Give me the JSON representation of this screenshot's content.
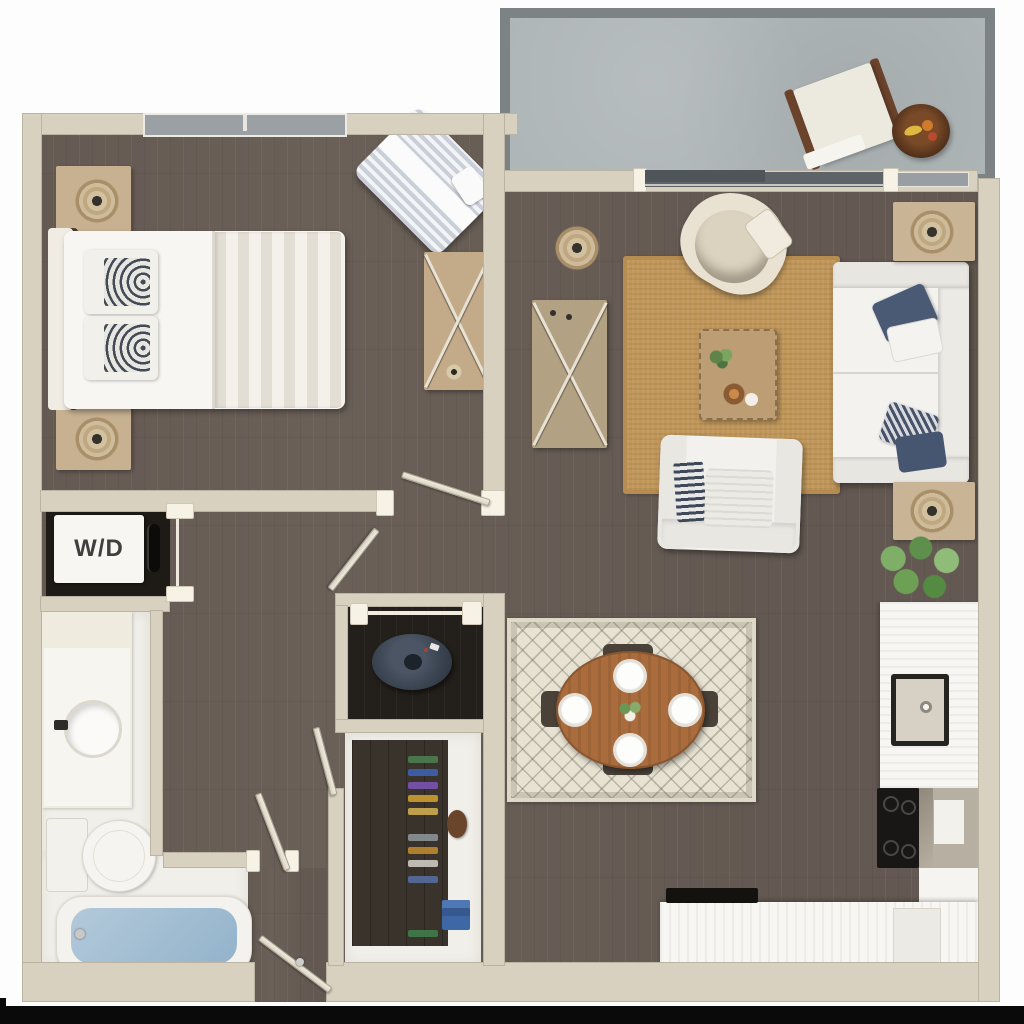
{
  "floorplan": {
    "title": "One-bedroom apartment 3D top-view floor plan",
    "washer_dryer_label": "W/D",
    "rooms": [
      "balcony",
      "bedroom",
      "living-room",
      "dining-area",
      "kitchen",
      "bathroom",
      "walk-in-closet",
      "storage-nook",
      "laundry-closet",
      "hallway",
      "entry"
    ],
    "furniture": {
      "balcony": [
        "sun-lounger",
        "fruit-bowl-table"
      ],
      "bedroom": [
        "queen-bed",
        "nightstand-with-lamp",
        "nightstand-with-lamp",
        "striped-chaise",
        "dresser"
      ],
      "living_room": [
        "sofa-with-navy-pillows",
        "accent-chair",
        "armchair",
        "coffee-table",
        "tv-console",
        "jute-rug",
        "side-table-with-lamp",
        "side-table-with-lamp",
        "pendant-lamp",
        "potted-plant"
      ],
      "dining": [
        "oval-wood-table",
        "dining-chair",
        "dining-chair",
        "dining-chair",
        "dining-chair",
        "patterned-rug",
        "place-setting-plates"
      ],
      "kitchen": [
        "counter-with-sink",
        "range-cooktop",
        "corner-cabinet",
        "island-counter",
        "dishwasher"
      ],
      "bathroom": [
        "vanity-with-sink",
        "toilet",
        "bathtub"
      ],
      "laundry": [
        "stacked-washer-dryer"
      ],
      "closet": [
        "hanging-clothes",
        "bag",
        "folded-towels"
      ],
      "nook": [
        "round-lounge-chair"
      ]
    },
    "colors": {
      "wall": "#d9d1c0",
      "wood_floor": "#6b6058",
      "balcony_floor": "#afb6b8",
      "balcony_border": "#7d8285",
      "bathroom_floor": "#f1efe9",
      "jute_rug": "#c09659",
      "dining_rug": "#e7e2d2",
      "dining_table": "#aa6c3c",
      "sofa_pillow_navy": "#4b5a75",
      "tub_water": "#a7c2d6",
      "appliance_black": "#191715",
      "frame_bar": "#0a0a0a"
    }
  }
}
